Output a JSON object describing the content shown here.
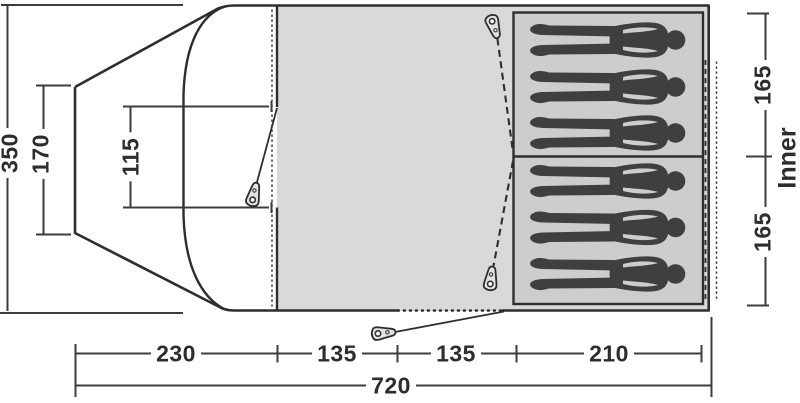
{
  "diagram": {
    "type": "tent-floorplan-top-view",
    "labels": {
      "inner": "Inner"
    },
    "dimensions": {
      "depth_total": "350",
      "front_edge": "170",
      "porch_door": "115",
      "inner_cabin_top": "165",
      "inner_cabin_bottom": "165",
      "width_total": "720",
      "width_sections": [
        "230",
        "135",
        "135",
        "210"
      ]
    },
    "figures": {
      "cabins": 2,
      "per_cabin": 3,
      "icon": "person-silhouette"
    },
    "pegs": {
      "count": 3,
      "icon": "tent-peg"
    },
    "colors": {
      "line": "#2e2e2e",
      "dim": "#3c3c3c",
      "text": "#2d2d2d",
      "floor": "#d9d9d9",
      "cabin": "#cdcdcd",
      "figure": "#3f3f3f",
      "peg": "#e2e2e2",
      "bg": "#ffffff"
    }
  }
}
